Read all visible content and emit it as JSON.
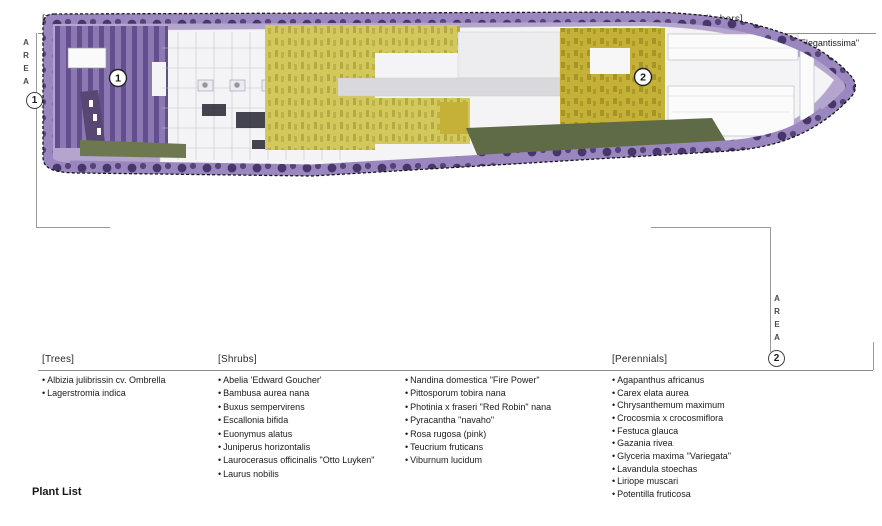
{
  "page": {
    "footer_title": "Plant List"
  },
  "area1": {
    "letters": [
      "A",
      "R",
      "E",
      "A"
    ],
    "number": "1",
    "trees": {
      "header": "[Trees]",
      "items": [
        "Ligustrum japonicum",
        "Liquidambar orientalis",
        "Magnolia grandiflora",
        "Taxus baccata \"Conica\""
      ]
    },
    "shrubs": {
      "header": "[Shrubs]",
      "col1": [
        "Abelia 'Edward Goucher'",
        "Bambusa aurea",
        "Escallonia bifida",
        "Euonymus alatus",
        "Laurus nobilis",
        "Lonicera nitida aurea",
        "Loropetalum chinense \"rubra\""
      ],
      "col2": [
        "Nandina domestica",
        "Phormium tenax \"atropurpureum\"",
        "Pittosporum tobira nana",
        "Phormium tenax variegatum",
        "Photinia x fraseri \"Red Robin\" nana",
        "Viburnum lucidum"
      ]
    },
    "perennials": {
      "header": "[Perennials]",
      "items": [
        "Aspidistra edulis",
        "Glyceria maxima \"Variegata\"",
        "Hypericum calcicum",
        "Lavandula stoechas",
        "Liriope muscari"
      ]
    },
    "climbers": {
      "header": "[Climbers]",
      "items": [
        "Hedera helix \"Marginata Elegantissima\"",
        "Hedera helix \"Gold Heart\"",
        "Rhyncospermum jasminoides",
        "Wisteria sinensis",
        "Parthenocissus quinquefolia",
        "Passiflora caerulea"
      ]
    }
  },
  "area2": {
    "letters": [
      "A",
      "R",
      "E",
      "A"
    ],
    "number": "2",
    "trees": {
      "header": "[Trees]",
      "items": [
        "Albizia julibrissin cv. Ombrella",
        "Lagerstromia indica"
      ]
    },
    "shrubs": {
      "header": "[Shrubs]",
      "col1": [
        "Abelia 'Edward Goucher'",
        "Bambusa aurea nana",
        "Buxus sempervirens",
        "Escallonia bifida",
        "Euonymus alatus",
        "Juniperus horizontalis",
        "Laurocerasus officinalis \"Otto Luyken\"",
        "Laurus nobilis"
      ],
      "col2": [
        "Nandina domestica \"Fire Power\"",
        "Pittosporum tobira nana",
        "Photinia x fraseri \"Red Robin\" nana",
        "Pyracantha \"navaho\"",
        "Rosa rugosa (pink)",
        "Teucrium fruticans",
        "Viburnum lucidum"
      ]
    },
    "perennials": {
      "header": "[Perennials]",
      "items": [
        "Agapanthus africanus",
        "Carex elata aurea",
        "Chrysanthemum maximum",
        "Crocosmia x crocosmiflora",
        "Festuca glauca",
        "Gazania rivea",
        "Glyceria maxima \"Variegata\"",
        "Lavandula stoechas",
        "Liriope muscari",
        "Potentilla fruticosa"
      ]
    }
  },
  "plan": {
    "markers": {
      "area1": "1",
      "area2": "2"
    },
    "colors": {
      "lavender": "#b4a5ce",
      "band": "#9b87bf",
      "blob": "#473669",
      "garden": "#8d79b2",
      "stripe": "#5e4a8c",
      "road": "#584673",
      "building": "#f4f4f6",
      "grid": "#c6c6d0",
      "chartreuse": "#d2c85c",
      "chartreuse_dark": "#ada33d",
      "mustard": "#c6b138",
      "mustard_dark": "#9c8b22",
      "olive": "#5f6a46",
      "olive2": "#6d7850",
      "roof": "#ededf0",
      "gray_strip": "#d8d8dd",
      "dark_detail": "#2c2c38",
      "boundary": "#161616"
    }
  }
}
